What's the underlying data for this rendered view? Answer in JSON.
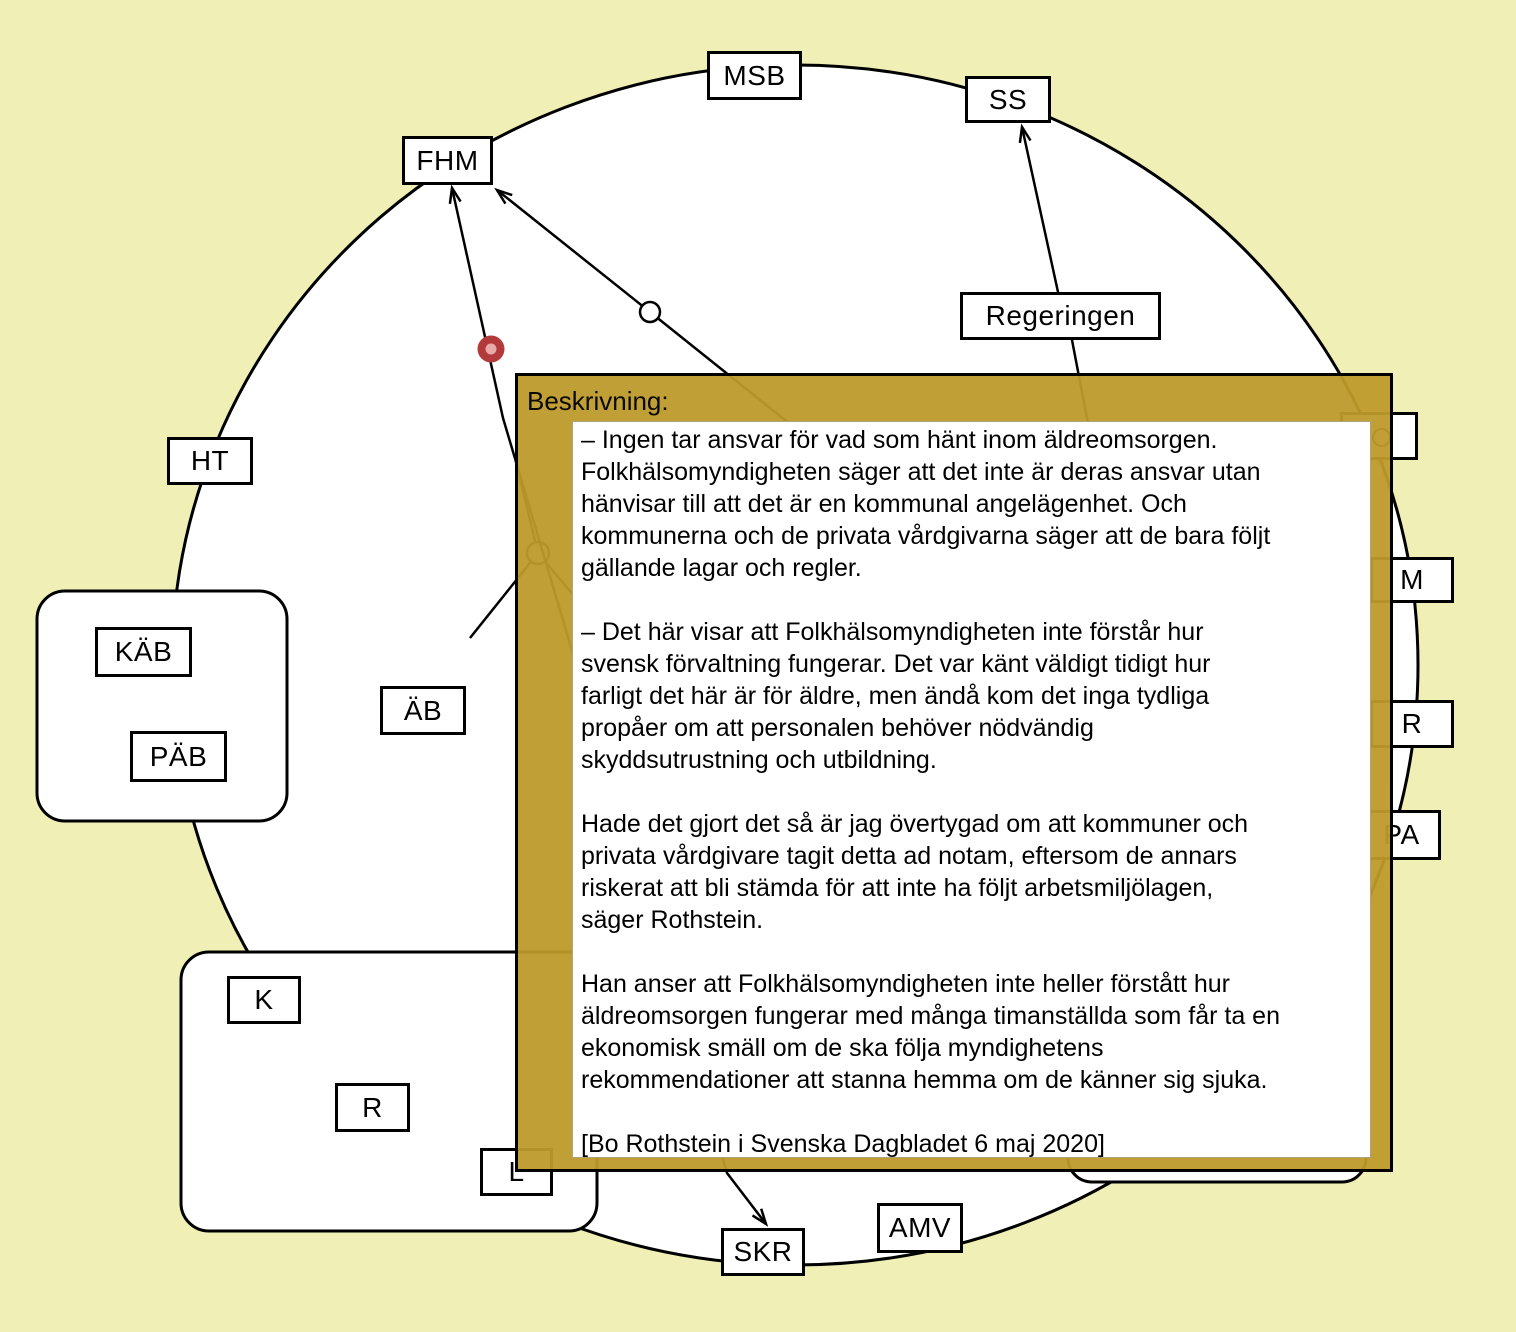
{
  "colors": {
    "background": "#f0efb5",
    "panel_gold": "#c2a136",
    "panel_border": "#000000",
    "panel_inner_bg": "#ffffff",
    "node_fill": "#ffffff",
    "node_border": "#000000",
    "line": "#000000",
    "red_dot_outer": "#b23a3a",
    "red_dot_inner": "#e9a9a9"
  },
  "diagram": {
    "boundary_shape": "ellipse",
    "nodes": [
      {
        "id": "FHM",
        "label": "FHM",
        "x": 402,
        "y": 136,
        "w": 91,
        "h": 49
      },
      {
        "id": "MSB",
        "label": "MSB",
        "x": 707,
        "y": 51,
        "w": 95,
        "h": 49
      },
      {
        "id": "SS",
        "label": "SS",
        "x": 965,
        "y": 76,
        "w": 86,
        "h": 47
      },
      {
        "id": "Regeringen",
        "label": "Regeringen",
        "x": 960,
        "y": 292,
        "w": 201,
        "h": 48
      },
      {
        "id": "HT",
        "label": "HT",
        "x": 167,
        "y": 437,
        "w": 86,
        "h": 48
      },
      {
        "id": "KAB",
        "label": "KÄB",
        "x": 95,
        "y": 627,
        "w": 97,
        "h": 50
      },
      {
        "id": "PAB",
        "label": "PÄB",
        "x": 130,
        "y": 731,
        "w": 97,
        "h": 51
      },
      {
        "id": "AB",
        "label": "ÄB",
        "x": 380,
        "y": 686,
        "w": 86,
        "h": 49
      },
      {
        "id": "K",
        "label": "K",
        "x": 227,
        "y": 976,
        "w": 74,
        "h": 48
      },
      {
        "id": "R1",
        "label": "R",
        "x": 335,
        "y": 1083,
        "w": 75,
        "h": 49
      },
      {
        "id": "L",
        "label": "L",
        "x": 480,
        "y": 1148,
        "w": 73,
        "h": 48
      },
      {
        "id": "SKR",
        "label": "SKR",
        "x": 721,
        "y": 1228,
        "w": 84,
        "h": 48
      },
      {
        "id": "AMV",
        "label": "AMV",
        "x": 877,
        "y": 1203,
        "w": 86,
        "h": 50
      },
      {
        "id": "M",
        "label": "M",
        "x": 1370,
        "y": 557,
        "w": 84,
        "h": 46
      },
      {
        "id": "R2",
        "label": "R",
        "x": 1370,
        "y": 700,
        "w": 84,
        "h": 48
      },
      {
        "id": "PA",
        "label": "PA",
        "x": 1362,
        "y": 810,
        "w": 79,
        "h": 50
      },
      {
        "id": "hidden",
        "label": "",
        "x": 1340,
        "y": 412,
        "w": 78,
        "h": 48
      }
    ],
    "containers": [
      {
        "id": "group-kab-pab",
        "x": 37,
        "y": 591,
        "w": 250,
        "h": 230
      },
      {
        "id": "group-k-r-l",
        "x": 181,
        "y": 952,
        "w": 416,
        "h": 279
      },
      {
        "id": "group-bottom-right",
        "x": 1068,
        "y": 990,
        "w": 298,
        "h": 192
      }
    ],
    "edges": [
      {
        "to": "FHM",
        "marker": "red-dot"
      },
      {
        "to": "FHM",
        "marker": "open-circle"
      },
      {
        "to": "SS",
        "via": "Regeringen"
      },
      {
        "to": "SKR"
      }
    ]
  },
  "description_panel": {
    "title": "Beskrivning:",
    "paragraphs": [
      {
        "lines": [
          "– Ingen tar ansvar för vad som hänt inom äldreomsorgen.",
          "Folkhälsomyndigheten säger att det inte är deras ansvar utan",
          "hänvisar till att det är en kommunal angelägenhet. Och",
          "kommunerna och de privata vårdgivarna säger att de bara följt",
          "gällande lagar och regler."
        ]
      },
      {
        "lines": [
          "– Det här visar att Folkhälsomyndigheten inte förstår hur",
          "svensk förvaltning fungerar. Det var känt väldigt tidigt hur",
          "farligt det här är för äldre, men ändå kom det inga tydliga",
          "propåer om att personalen behöver nödvändig",
          "skyddsutrustning och utbildning."
        ]
      },
      {
        "lines": [
          "Hade det gjort det så är jag övertygad om att kommuner och",
          "privata vårdgivare tagit detta ad notam, eftersom de annars",
          "riskerat att bli stämda för att inte ha följt arbetsmiljölagen,",
          "säger Rothstein."
        ]
      },
      {
        "lines": [
          "Han anser att Folkhälsomyndigheten inte heller förstått hur",
          "äldreomsorgen fungerar med många timanställda som får ta en",
          "ekonomisk smäll om de ska följa myndighetens",
          "rekommendationer att stanna hemma om de känner sig sjuka."
        ]
      },
      {
        "lines": [
          "[Bo Rothstein i Svenska Dagbladet 6 maj 2020]"
        ]
      }
    ]
  }
}
